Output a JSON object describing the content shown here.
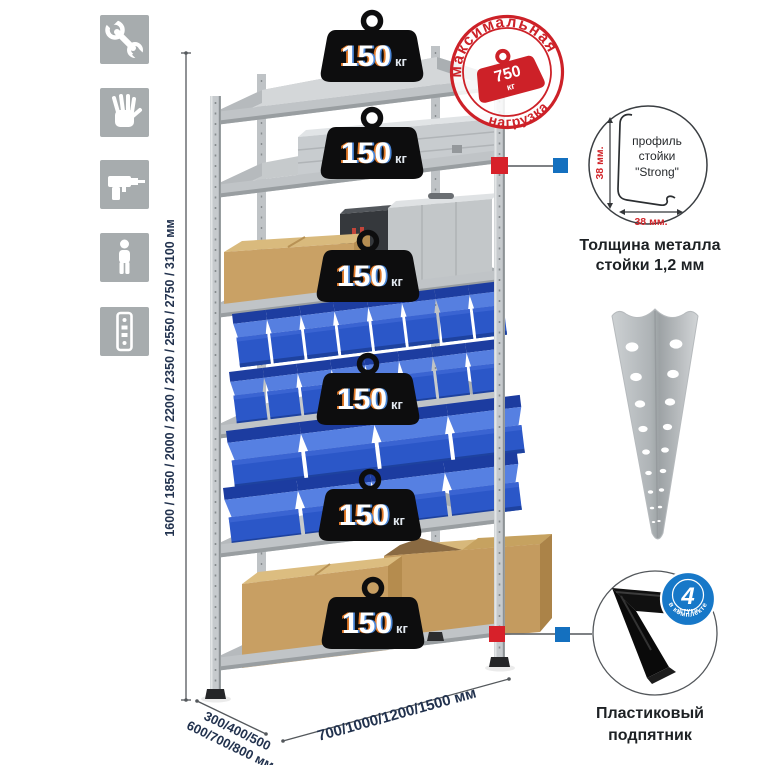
{
  "side_icons": [
    {
      "name": "wrench"
    },
    {
      "name": "gloves"
    },
    {
      "name": "drill"
    },
    {
      "name": "person"
    },
    {
      "name": "rack-post"
    }
  ],
  "dimensions": {
    "height_label": "1600 / 1850 / 2000 / 2200 / 2350 / 2550 / 2750 / 3100 мм",
    "depth_label_line1": "300/400/500",
    "depth_label_line2": "600/700/800 мм",
    "width_label": "700/1000/1200/1500 мм"
  },
  "weights": [
    {
      "value": "150",
      "unit": "кг"
    },
    {
      "value": "150",
      "unit": "кг"
    },
    {
      "value": "150",
      "unit": "кг"
    },
    {
      "value": "150",
      "unit": "кг"
    },
    {
      "value": "150",
      "unit": "кг"
    },
    {
      "value": "150",
      "unit": "кг"
    }
  ],
  "stamp": {
    "arc_top": "максимальная",
    "arc_bottom": "нагрузка",
    "weight_value": "750",
    "weight_unit": "кг"
  },
  "profile_detail": {
    "label_line1": "профиль",
    "label_line2": "стойки",
    "label_line3": "\"Strong\"",
    "dim_vertical": "38 мм.",
    "dim_horizontal": "38 мм.",
    "caption_line1": "Толщина металла",
    "caption_line2": "стойки 1,2 мм"
  },
  "foot_detail": {
    "badge_value": "4",
    "badge_sub": "штуки",
    "badge_arc": "в комплекте",
    "caption_line1": "Пластиковый",
    "caption_line2": "подпятник"
  },
  "colors": {
    "stamp_red": "#cd2128",
    "marker_red": "#d7212a",
    "marker_blue": "#1470bf",
    "navy_text": "#22324e",
    "metal_gray": "#c6cacd",
    "bin_blue": "#2b57c8",
    "cardboard": "#c9a165"
  }
}
